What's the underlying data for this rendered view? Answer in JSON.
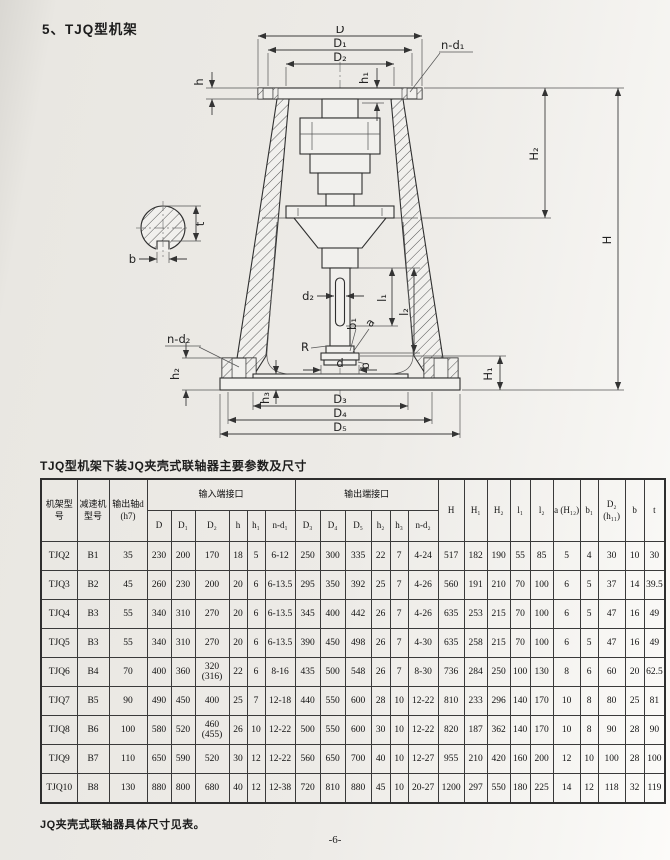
{
  "page": {
    "title": "5、TJQ型机架",
    "table_caption": "TJQ型机架下装JQ夹壳式联轴器主要参数及尺寸",
    "footnote": "JQ夹壳式联轴器具体尺寸见表。",
    "page_number": "-6-"
  },
  "drawing": {
    "labels": {
      "D": "D",
      "D1": "D₁",
      "D2": "D₂",
      "h": "h",
      "h1": "h₁",
      "n_d1": "n-d₁",
      "H": "H",
      "H1": "H₁",
      "H2": "H₂",
      "l1": "l₁",
      "l2": "l₂",
      "d2": "d₂",
      "R": "R",
      "a": "a",
      "b1": "b₁",
      "b": "b",
      "d": "d",
      "n_d2": "n-d₂",
      "h2": "h₂",
      "h3": "h₃",
      "D3": "D₃",
      "D4": "D₄",
      "D5": "D₅",
      "t": "t",
      "b_sec": "b"
    }
  },
  "table": {
    "header": {
      "col_frame": "机架型号",
      "col_reducer": "减速机型号",
      "col_shaft": "输出轴d (h7)",
      "group_input": "输入端接口",
      "group_output": "输出端接口",
      "input_cols": [
        "D",
        "D₁",
        "D₂",
        "h",
        "h₁",
        "n-d₁"
      ],
      "output_cols": [
        "D₃",
        "D₄",
        "D₅",
        "h₂",
        "h₃",
        "n-d₂"
      ],
      "tail_cols": [
        "H",
        "H₁",
        "H₂",
        "l₁",
        "l₂",
        "a (H₁₂)",
        "b₁",
        "D₂ (h₁₁)",
        "b",
        "t"
      ]
    },
    "rows": [
      [
        "TJQ2",
        "B1",
        "35",
        "230",
        "200",
        "170",
        "18",
        "5",
        "6-12",
        "250",
        "300",
        "335",
        "22",
        "7",
        "4-24",
        "517",
        "182",
        "190",
        "55",
        "85",
        "5",
        "4",
        "30",
        "10",
        "30"
      ],
      [
        "TJQ3",
        "B2",
        "45",
        "260",
        "230",
        "200",
        "20",
        "6",
        "6-13.5",
        "295",
        "350",
        "392",
        "25",
        "7",
        "4-26",
        "560",
        "191",
        "210",
        "70",
        "100",
        "6",
        "5",
        "37",
        "14",
        "39.5"
      ],
      [
        "TJQ4",
        "B3",
        "55",
        "340",
        "310",
        "270",
        "20",
        "6",
        "6-13.5",
        "345",
        "400",
        "442",
        "26",
        "7",
        "4-26",
        "635",
        "253",
        "215",
        "70",
        "100",
        "6",
        "5",
        "47",
        "16",
        "49"
      ],
      [
        "TJQ5",
        "B3",
        "55",
        "340",
        "310",
        "270",
        "20",
        "6",
        "6-13.5",
        "390",
        "450",
        "498",
        "26",
        "7",
        "4-30",
        "635",
        "258",
        "215",
        "70",
        "100",
        "6",
        "5",
        "47",
        "16",
        "49"
      ],
      [
        "TJQ6",
        "B4",
        "70",
        "400",
        "360",
        "320\n(316)",
        "22",
        "6",
        "8-16",
        "435",
        "500",
        "548",
        "26",
        "7",
        "8-30",
        "736",
        "284",
        "250",
        "100",
        "130",
        "8",
        "6",
        "60",
        "20",
        "62.5"
      ],
      [
        "TJQ7",
        "B5",
        "90",
        "490",
        "450",
        "400",
        "25",
        "7",
        "12-18",
        "440",
        "550",
        "600",
        "28",
        "10",
        "12-22",
        "810",
        "233",
        "296",
        "140",
        "170",
        "10",
        "8",
        "80",
        "25",
        "81"
      ],
      [
        "TJQ8",
        "B6",
        "100",
        "580",
        "520",
        "460\n(455)",
        "26",
        "10",
        "12-22",
        "500",
        "550",
        "600",
        "30",
        "10",
        "12-22",
        "820",
        "187",
        "362",
        "140",
        "170",
        "10",
        "8",
        "90",
        "28",
        "90"
      ],
      [
        "TJQ9",
        "B7",
        "110",
        "650",
        "590",
        "520",
        "30",
        "12",
        "12-22",
        "560",
        "650",
        "700",
        "40",
        "10",
        "12-27",
        "955",
        "210",
        "420",
        "160",
        "200",
        "12",
        "10",
        "100",
        "28",
        "100"
      ],
      [
        "TJQ10",
        "B8",
        "130",
        "880",
        "800",
        "680",
        "40",
        "12",
        "12-38",
        "720",
        "810",
        "880",
        "45",
        "10",
        "20-27",
        "1200",
        "297",
        "550",
        "180",
        "225",
        "14",
        "12",
        "118",
        "32",
        "119"
      ]
    ]
  }
}
